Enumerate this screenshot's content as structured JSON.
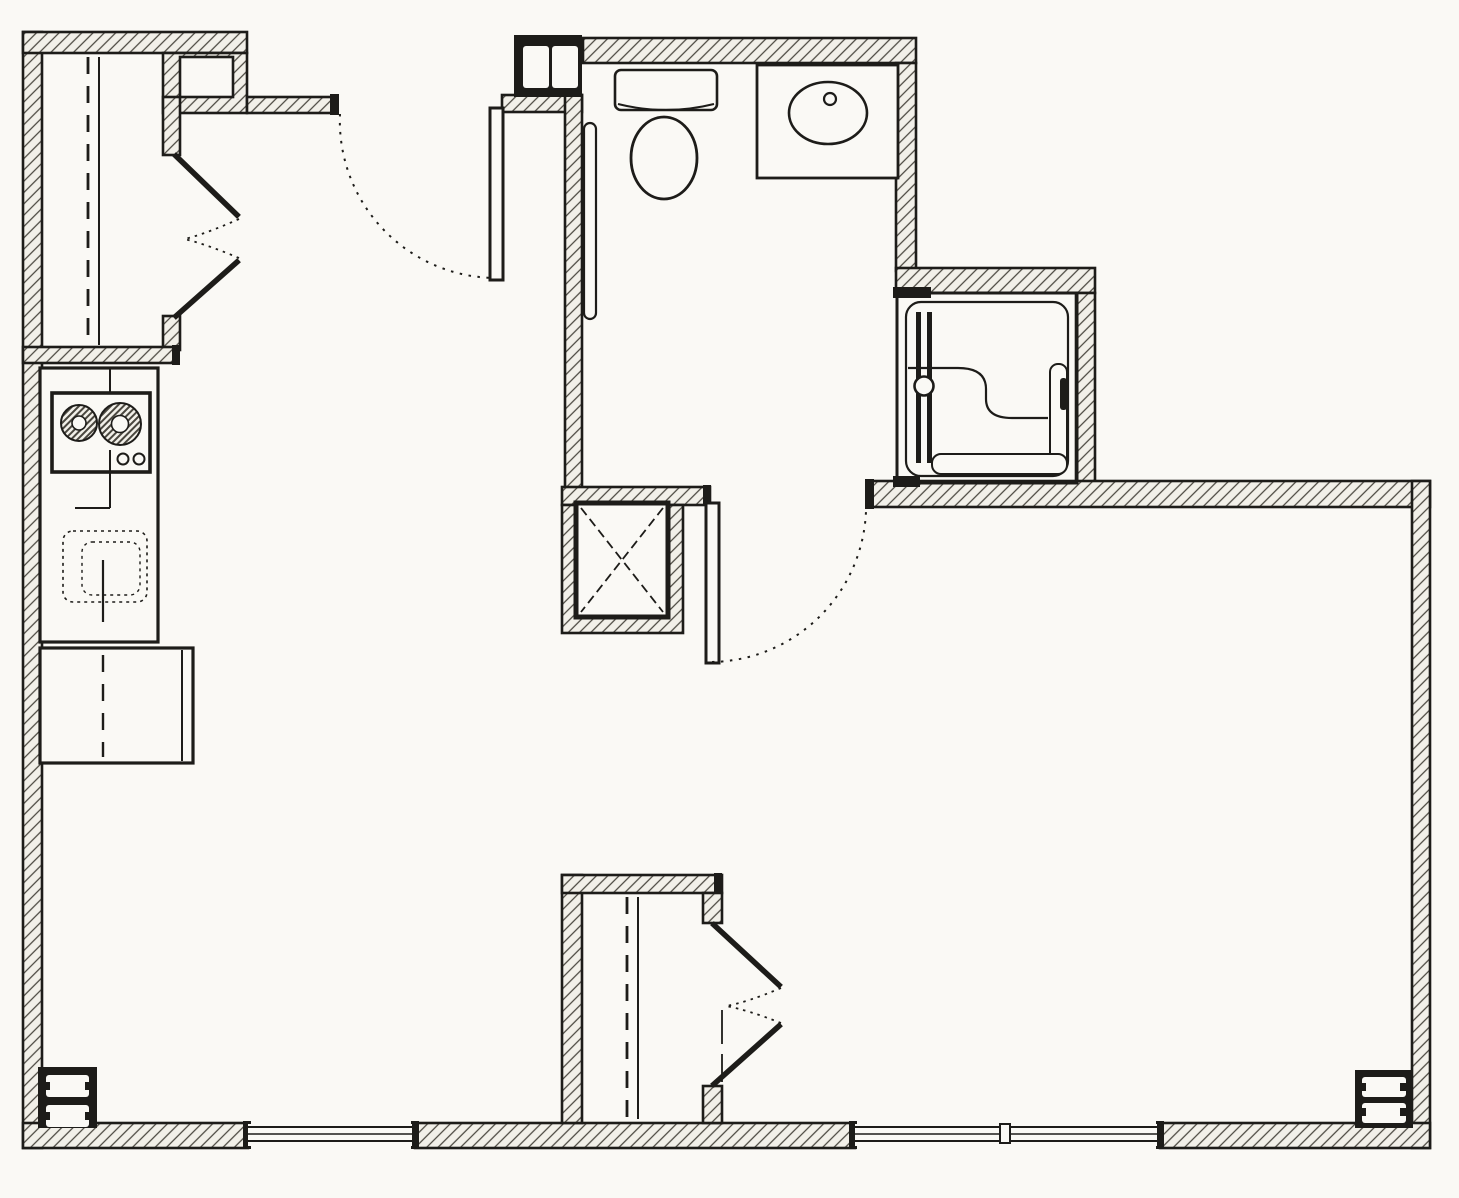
{
  "document": {
    "type": "architectural floor plan",
    "title": "Black-and-white one-bedroom / studio apartment floor plan drawing",
    "drawing_conventions": "diagonally hatched walls, dashed door-swing arcs, dashed closet rods, plumbing fixtures in plan view",
    "visible_text_labels": []
  },
  "colors": {
    "paper": "#faf9f5",
    "ink": "#1d1c19",
    "hatch_bg": "#f2f0e9",
    "hatch_ink": "#4a473f"
  },
  "rooms": [
    {
      "id": "entry-closet",
      "location": "top-left",
      "features": [
        "double hinged doors opening right",
        "dashed closet rod line",
        "solid shelf line",
        "boxed niche in wall corner"
      ]
    },
    {
      "id": "kitchen",
      "location": "left",
      "features": [
        "straight counter run",
        "two-burner cooktop with two control knobs",
        "under-counter sink shown dotted with center divider",
        "refrigerator box with double door-edge line and dashed centerline"
      ]
    },
    {
      "id": "entry-hall",
      "location": "top-center-left",
      "features": [
        "entry door leaf open against bathroom wall",
        "dotted quarter-circle swing arc",
        "H-section steel column at jamb"
      ]
    },
    {
      "id": "bathroom",
      "location": "top-center",
      "features": [
        "toilet with tank and oval bowl",
        "vanity counter with oval lavatory and faucet dot",
        "vertical grab bar on left wall",
        "hinged door at bottom with dotted swing arc"
      ]
    },
    {
      "id": "shower",
      "location": "top-right",
      "features": [
        "square shower stall",
        "sliding door with two tracks and round knob",
        "S-curved seat line",
        "L-shaped bench along right and bottom"
      ]
    },
    {
      "id": "duct-chase",
      "location": "center",
      "features": [
        "hatched shaft with inner box crossed by dashed X"
      ]
    },
    {
      "id": "bedroom-closet",
      "location": "bottom-center",
      "features": [
        "double hinged doors opening right",
        "dashed closet rod line",
        "solid shelf line"
      ]
    },
    {
      "id": "living-sleeping-area",
      "location": "right / bottom",
      "features": [
        "large open area, no furniture drawn"
      ]
    }
  ],
  "doors": [
    {
      "id": "entry-door",
      "type": "hinged",
      "state": "open 90 degrees, dotted swing arc"
    },
    {
      "id": "bathroom-door",
      "type": "hinged",
      "state": "open 90 degrees, dotted swing arc"
    },
    {
      "id": "entry-closet-doors",
      "type": "double hinged pair",
      "state": "partially open with dotted arcs"
    },
    {
      "id": "bedroom-closet-doors",
      "type": "double hinged pair",
      "state": "partially open with dotted arcs"
    },
    {
      "id": "shower-door",
      "type": "sliding",
      "state": "closed, knob at center"
    }
  ],
  "windows": [
    {
      "id": "south-window-left",
      "wall": "bottom",
      "from_x": 248,
      "to_x": 415,
      "lites": 1
    },
    {
      "id": "south-window-right",
      "wall": "bottom",
      "from_x": 855,
      "to_x": 1160,
      "lites": 2,
      "mullion_x": 1005
    }
  ],
  "columns": [
    {
      "id": "entry-column",
      "symbol": "steel H-section in black box",
      "x": 514,
      "y": 35
    },
    {
      "id": "southwest-column",
      "symbol": "steel H-section in black box",
      "x": 38,
      "y": 1067
    },
    {
      "id": "southeast-column",
      "symbol": "steel H-section in black box",
      "x": 1355,
      "y": 1070
    }
  ]
}
